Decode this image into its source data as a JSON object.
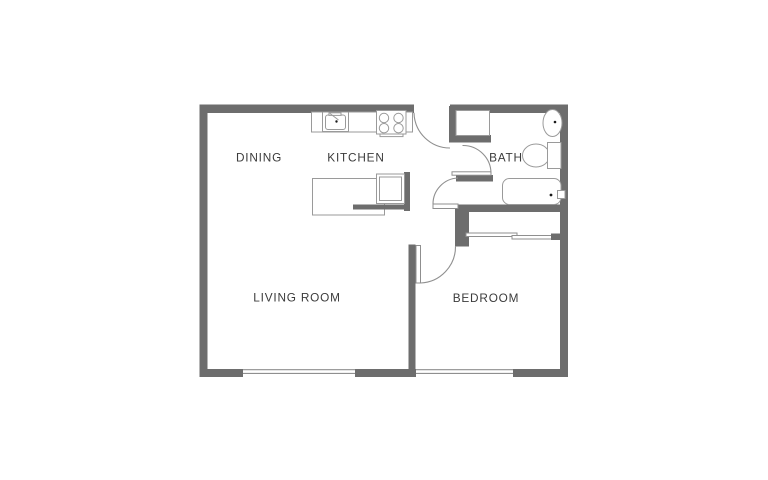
{
  "floorplan": {
    "kind": "apartment-floor-plan",
    "rooms": [
      {
        "id": "dining",
        "label": "DINING"
      },
      {
        "id": "kitchen",
        "label": "KITCHEN"
      },
      {
        "id": "bath",
        "label": "BATH"
      },
      {
        "id": "living_room",
        "label": "LIVING ROOM"
      },
      {
        "id": "bedroom",
        "label": "BEDROOM"
      }
    ],
    "fixtures": [
      "kitchen-sink",
      "stove-burners",
      "kitchen-island-counter",
      "refrigerator",
      "entry-closet",
      "bath-sink",
      "toilet",
      "bathtub",
      "bedroom-closet-sliding-doors",
      "living-room-window",
      "bedroom-window",
      "entry-door-swing",
      "bath-door-swing",
      "hall-door-swing",
      "bedroom-door-swing"
    ],
    "colors": {
      "wall": "#6d6d6d",
      "fixture": "#9a9a9a",
      "door": "#8f8f8f",
      "text": "#3b3b3b",
      "bg": "#ffffff"
    }
  }
}
